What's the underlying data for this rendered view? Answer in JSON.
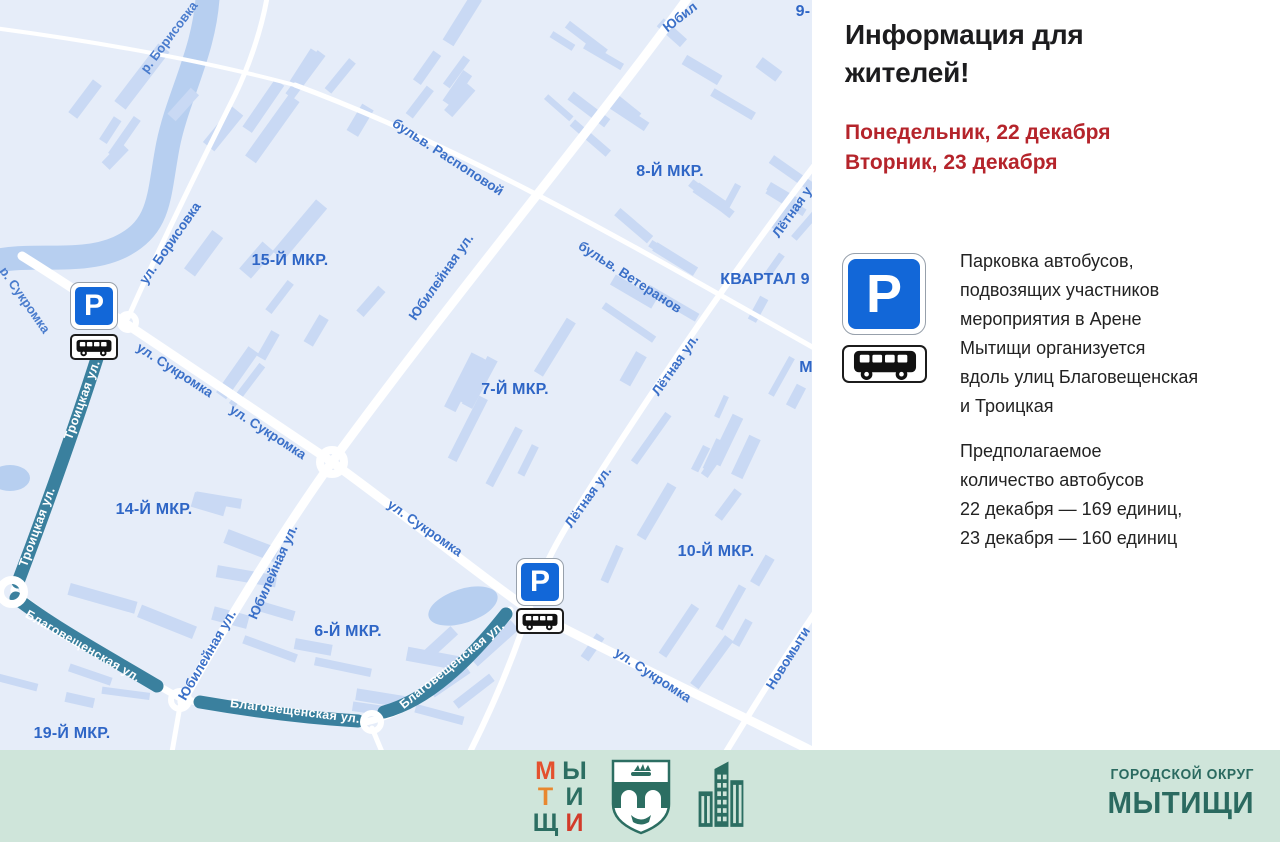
{
  "signs": {
    "parking_letter": "Р"
  },
  "panel": {
    "title": "Информация для\nжителей!",
    "dates": "Понедельник, 22 декабря\nВторник, 23 декабря",
    "body1": "Парковка автобусов,\nподвозящих участников\nмероприятия в Арене\nМытищи организуется\nвдоль улиц Благовещенская\nи Троицкая",
    "body2": "Предполагаемое\nколичество автобусов\n22 декабря — 169 единиц,\n23 декабря — 160 единиц"
  },
  "map": {
    "district_labels": [
      {
        "text": "15-Й МКР.",
        "x": 290,
        "y": 261
      },
      {
        "text": "8-Й МКР.",
        "x": 670,
        "y": 172
      },
      {
        "text": "КВАРТАЛ 9",
        "x": 765,
        "y": 280
      },
      {
        "text": "7-Й МКР.",
        "x": 515,
        "y": 390
      },
      {
        "text": "14-Й МКР.",
        "x": 154,
        "y": 510
      },
      {
        "text": "10-Й МКР.",
        "x": 716,
        "y": 552
      },
      {
        "text": "6-Й МКР.",
        "x": 348,
        "y": 632
      },
      {
        "text": "19-Й МКР.",
        "x": 72,
        "y": 734
      },
      {
        "text": "9-",
        "x": 803,
        "y": 12
      },
      {
        "text": "М",
        "x": 806,
        "y": 368
      }
    ],
    "street_labels": [
      {
        "text": "р. Борисовка",
        "x": 169,
        "y": 37,
        "rot": -53,
        "kind": "river"
      },
      {
        "text": "р. Сукромка",
        "x": 25,
        "y": 300,
        "rot": 55,
        "kind": "river"
      },
      {
        "text": "ул. Борисовка",
        "x": 170,
        "y": 243,
        "rot": -55,
        "kind": "street"
      },
      {
        "text": "бульв. Распоповой",
        "x": 448,
        "y": 157,
        "rot": 33,
        "kind": "street"
      },
      {
        "text": "Юбилейная ул.",
        "x": 441,
        "y": 277,
        "rot": -55,
        "kind": "street"
      },
      {
        "text": "Юбил",
        "x": 680,
        "y": 17,
        "rot": -38,
        "kind": "street"
      },
      {
        "text": "бульв. Ветеранов",
        "x": 630,
        "y": 277,
        "rot": 33,
        "kind": "street"
      },
      {
        "text": "Лётная у",
        "x": 792,
        "y": 212,
        "rot": -55,
        "kind": "street"
      },
      {
        "text": "Лётная ул.",
        "x": 675,
        "y": 365,
        "rot": -55,
        "kind": "street"
      },
      {
        "text": "Лётная ул.",
        "x": 588,
        "y": 497,
        "rot": -55,
        "kind": "street"
      },
      {
        "text": "ул. Сукромка",
        "x": 175,
        "y": 370,
        "rot": 33,
        "kind": "street"
      },
      {
        "text": "ул. Сукромка",
        "x": 268,
        "y": 432,
        "rot": 33,
        "kind": "street"
      },
      {
        "text": "ул. Сукромка",
        "x": 425,
        "y": 528,
        "rot": 35,
        "kind": "street"
      },
      {
        "text": "ул. Сукромка",
        "x": 653,
        "y": 675,
        "rot": 33,
        "kind": "street"
      },
      {
        "text": "Юбилейная ул.",
        "x": 273,
        "y": 572,
        "rot": -66,
        "kind": "street"
      },
      {
        "text": "Юбилейная ул.",
        "x": 207,
        "y": 655,
        "rot": -60,
        "kind": "street"
      },
      {
        "text": "Новомыти",
        "x": 788,
        "y": 658,
        "rot": -58,
        "kind": "street"
      },
      {
        "text": "Троицкая ул.",
        "x": 82,
        "y": 400,
        "rot": -70,
        "kind": "route"
      },
      {
        "text": "Троицкая ул.",
        "x": 37,
        "y": 527,
        "rot": -70,
        "kind": "route"
      },
      {
        "text": "Благовещенская ул.",
        "x": 83,
        "y": 646,
        "rot": 30,
        "kind": "route"
      },
      {
        "text": "Благовещенская ул.",
        "x": 295,
        "y": 711,
        "rot": 7,
        "kind": "route"
      },
      {
        "text": "Благовещенская ул.",
        "x": 452,
        "y": 665,
        "rot": -39,
        "kind": "route"
      }
    ]
  },
  "footer": {
    "brand_letters": [
      {
        "ch": "М",
        "color": "#e4512e"
      },
      {
        "ch": "Ы",
        "color": "#2c6e62"
      },
      {
        "ch": "Т",
        "color": "#e8872f"
      },
      {
        "ch": "И",
        "color": "#2c6e62"
      },
      {
        "ch": "Щ",
        "color": "#2c6e62"
      },
      {
        "ch": "И",
        "color": "#d23b2a"
      }
    ],
    "org_line1": "ГОРОДСКОЙ ОКРУГ",
    "org_line2": "МЫТИЩИ"
  },
  "colors": {
    "map_bg": "#e6edf9",
    "building": "#c9d9f4",
    "river": "#b7cff0",
    "road": "#ffffff",
    "street_label": "#3b70c8",
    "district_label": "#2f66c6",
    "route_highlight": "#3a809e",
    "sign_blue": "#1267d8",
    "accent_red": "#b5242b",
    "footer_bg": "#cfe5da",
    "footer_teal": "#2b6a60"
  }
}
